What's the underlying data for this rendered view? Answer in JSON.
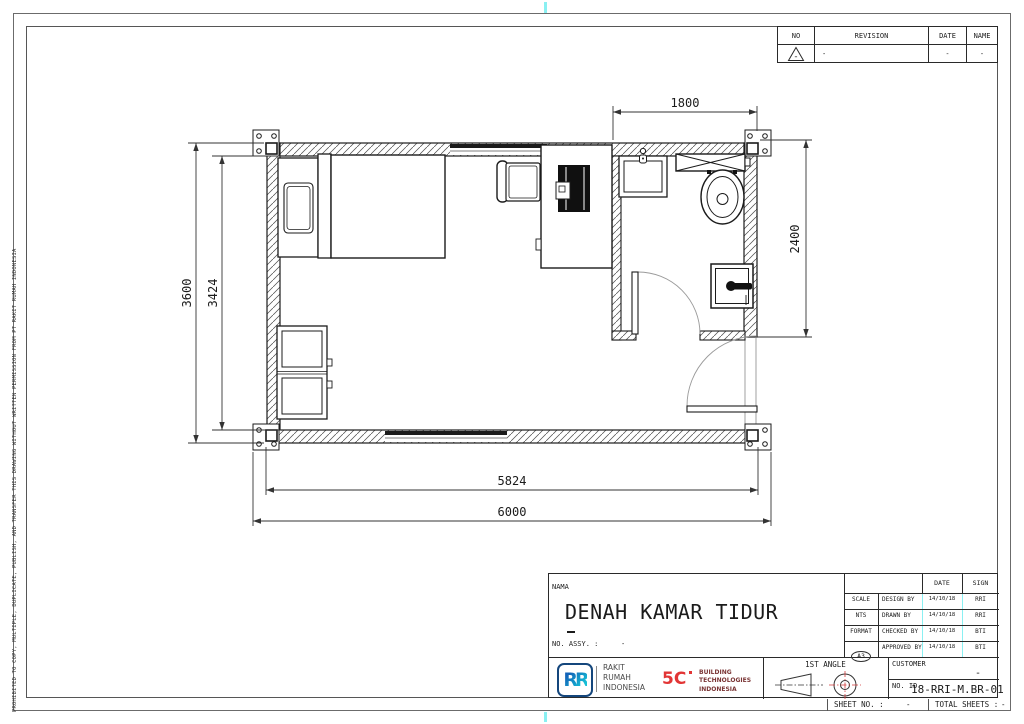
{
  "page": {
    "copyright": "PROHIBITED TO COPY, MULTIPLE, DUPLICATE, PUBLISH, AND TRANSFER THIS DRAWING WITHOUT WRITTEN PERMISSION FROM PT RAKIT RUMAH INDONESIA",
    "sheet_no_label": "SHEET NO. :",
    "sheet_no_value": "-",
    "total_sheets_label": "TOTAL SHEETS :",
    "total_sheets_value": "-",
    "fold_mark_color": "#8af0f2"
  },
  "revision_table": {
    "col_no": "NO",
    "col_revision": "REVISION",
    "col_date": "DATE",
    "col_name": "NAME",
    "row": {
      "no": "-",
      "revision": "-",
      "date": "-",
      "name": "-"
    }
  },
  "plan": {
    "dim_bathroom_width": "1800",
    "dim_bathroom_height": "2400",
    "dim_height_outer": "3600",
    "dim_height_inner": "3424",
    "dim_width_inner": "5824",
    "dim_width_outer": "6000"
  },
  "title_block": {
    "nama_label": "NAMA",
    "drawing_title": "DENAH KAMAR TIDUR",
    "no_assy_label": "NO. ASSY. :",
    "no_assy_value": "-",
    "date_header": "DATE",
    "sign_header": "SIGN",
    "scale_label": "SCALE",
    "scale_value": "NTS",
    "format_label": "FORMAT",
    "format_value": "A3",
    "approval_rows": [
      {
        "label": "DESIGN BY",
        "date": "14/10/18",
        "sign": "RRI"
      },
      {
        "label": "DRAWN BY",
        "date": "14/10/18",
        "sign": "RRI"
      },
      {
        "label": "CHECKED BY",
        "date": "14/10/18",
        "sign": "BTI"
      },
      {
        "label": "APPROVED BY",
        "date": "14/10/18",
        "sign": "BTI"
      }
    ],
    "rri_mark": "RR",
    "rri_name_l1": "RAKIT",
    "rri_name_l2": "RUMAH",
    "rri_name_l3": "INDONESIA",
    "bti_mark": "5C",
    "bti_name_l1": "BUILDING",
    "bti_name_l2": "TECHNOLOGIES",
    "bti_name_l3": "INDONESIA",
    "projection_label": "1ST ANGLE",
    "customer_label": "CUSTOMER",
    "customer_value": "-",
    "no_id_label": "NO. ID",
    "no_id_value": "18-RRI-M.BR-01",
    "brand_blue": "#1263b8",
    "brand_cyan": "#16c0d6",
    "brand_red": "#e23535"
  }
}
